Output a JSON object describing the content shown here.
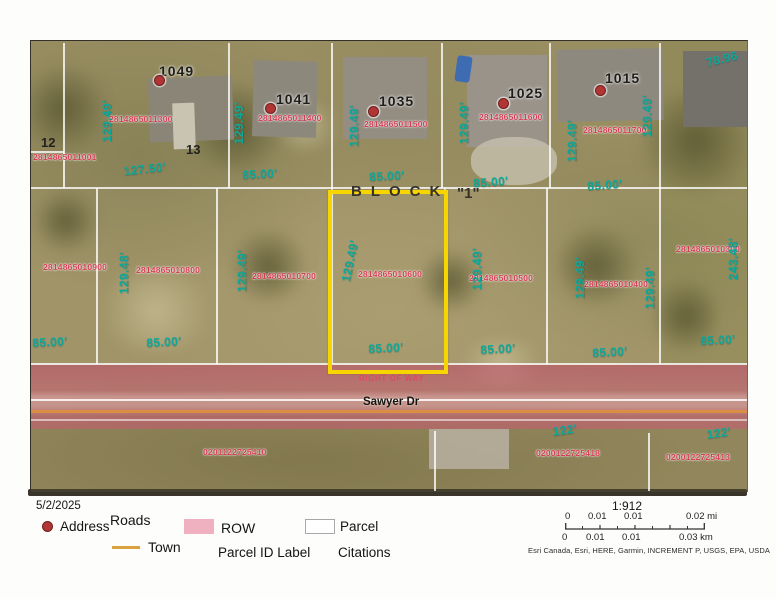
{
  "page": {
    "date": "5/2/2025"
  },
  "map": {
    "block_word": "BLOCK",
    "block_number": "\"1\"",
    "road_name": "Sawyer Dr",
    "right_of_way": "RIGHT OF WAY",
    "lot_numbers": {
      "left": "12",
      "right": "13"
    },
    "addresses": [
      {
        "number": "1049",
        "parcel_id": "2814865011300"
      },
      {
        "number": "1041",
        "parcel_id": "2814865011400"
      },
      {
        "number": "1035",
        "parcel_id": "2814865011500"
      },
      {
        "number": "1025",
        "parcel_id": "2814865011600"
      },
      {
        "number": "1015",
        "parcel_id": "2814865011700"
      }
    ],
    "west_parcel_id": "2814865011001",
    "block_parcels": [
      "2814865010900",
      "2814865010800",
      "2814865010700",
      "2814865010600",
      "2814865010500",
      "2814865010400",
      "2814865010300"
    ],
    "selected_parcel_id": "2814865010600",
    "south_parcel_ids": [
      "0201122725410",
      "0200122725418",
      "0200122725413"
    ],
    "dims": {
      "lot_depth": "129.49'",
      "lot_depth_alt": "129.48'",
      "lot13_width": "127.50'",
      "lot_width": "85.00'",
      "corner_width": "78.96",
      "east_depth": "243.48'",
      "road_frontage": "122'"
    }
  },
  "legend": {
    "address_label": "Address",
    "roads_label": "Roads",
    "town_label": "Town",
    "row_label": "ROW",
    "parcel_id_label": "Parcel ID Label",
    "parcel_label": "Parcel",
    "citations_label": "Citations"
  },
  "scalebar": {
    "ratio": "1:912",
    "mi": [
      "0",
      "0.01",
      "0.01",
      "0.02 mi"
    ],
    "km": [
      "0",
      "0.01",
      "0.01",
      "0.03 km"
    ],
    "attribution": "Esri Canada, Esri, HERE, Garmin, INCREMENT P, USGS, EPA, USDA"
  },
  "colors": {
    "selection_yellow": "#f6d500",
    "row_pink": "#d98a9e",
    "dimension_teal": "#0ea89b",
    "parcel_id_red": "#d53f55",
    "address_dot": "#b23535",
    "town_line_orange": "#d9a23f"
  }
}
